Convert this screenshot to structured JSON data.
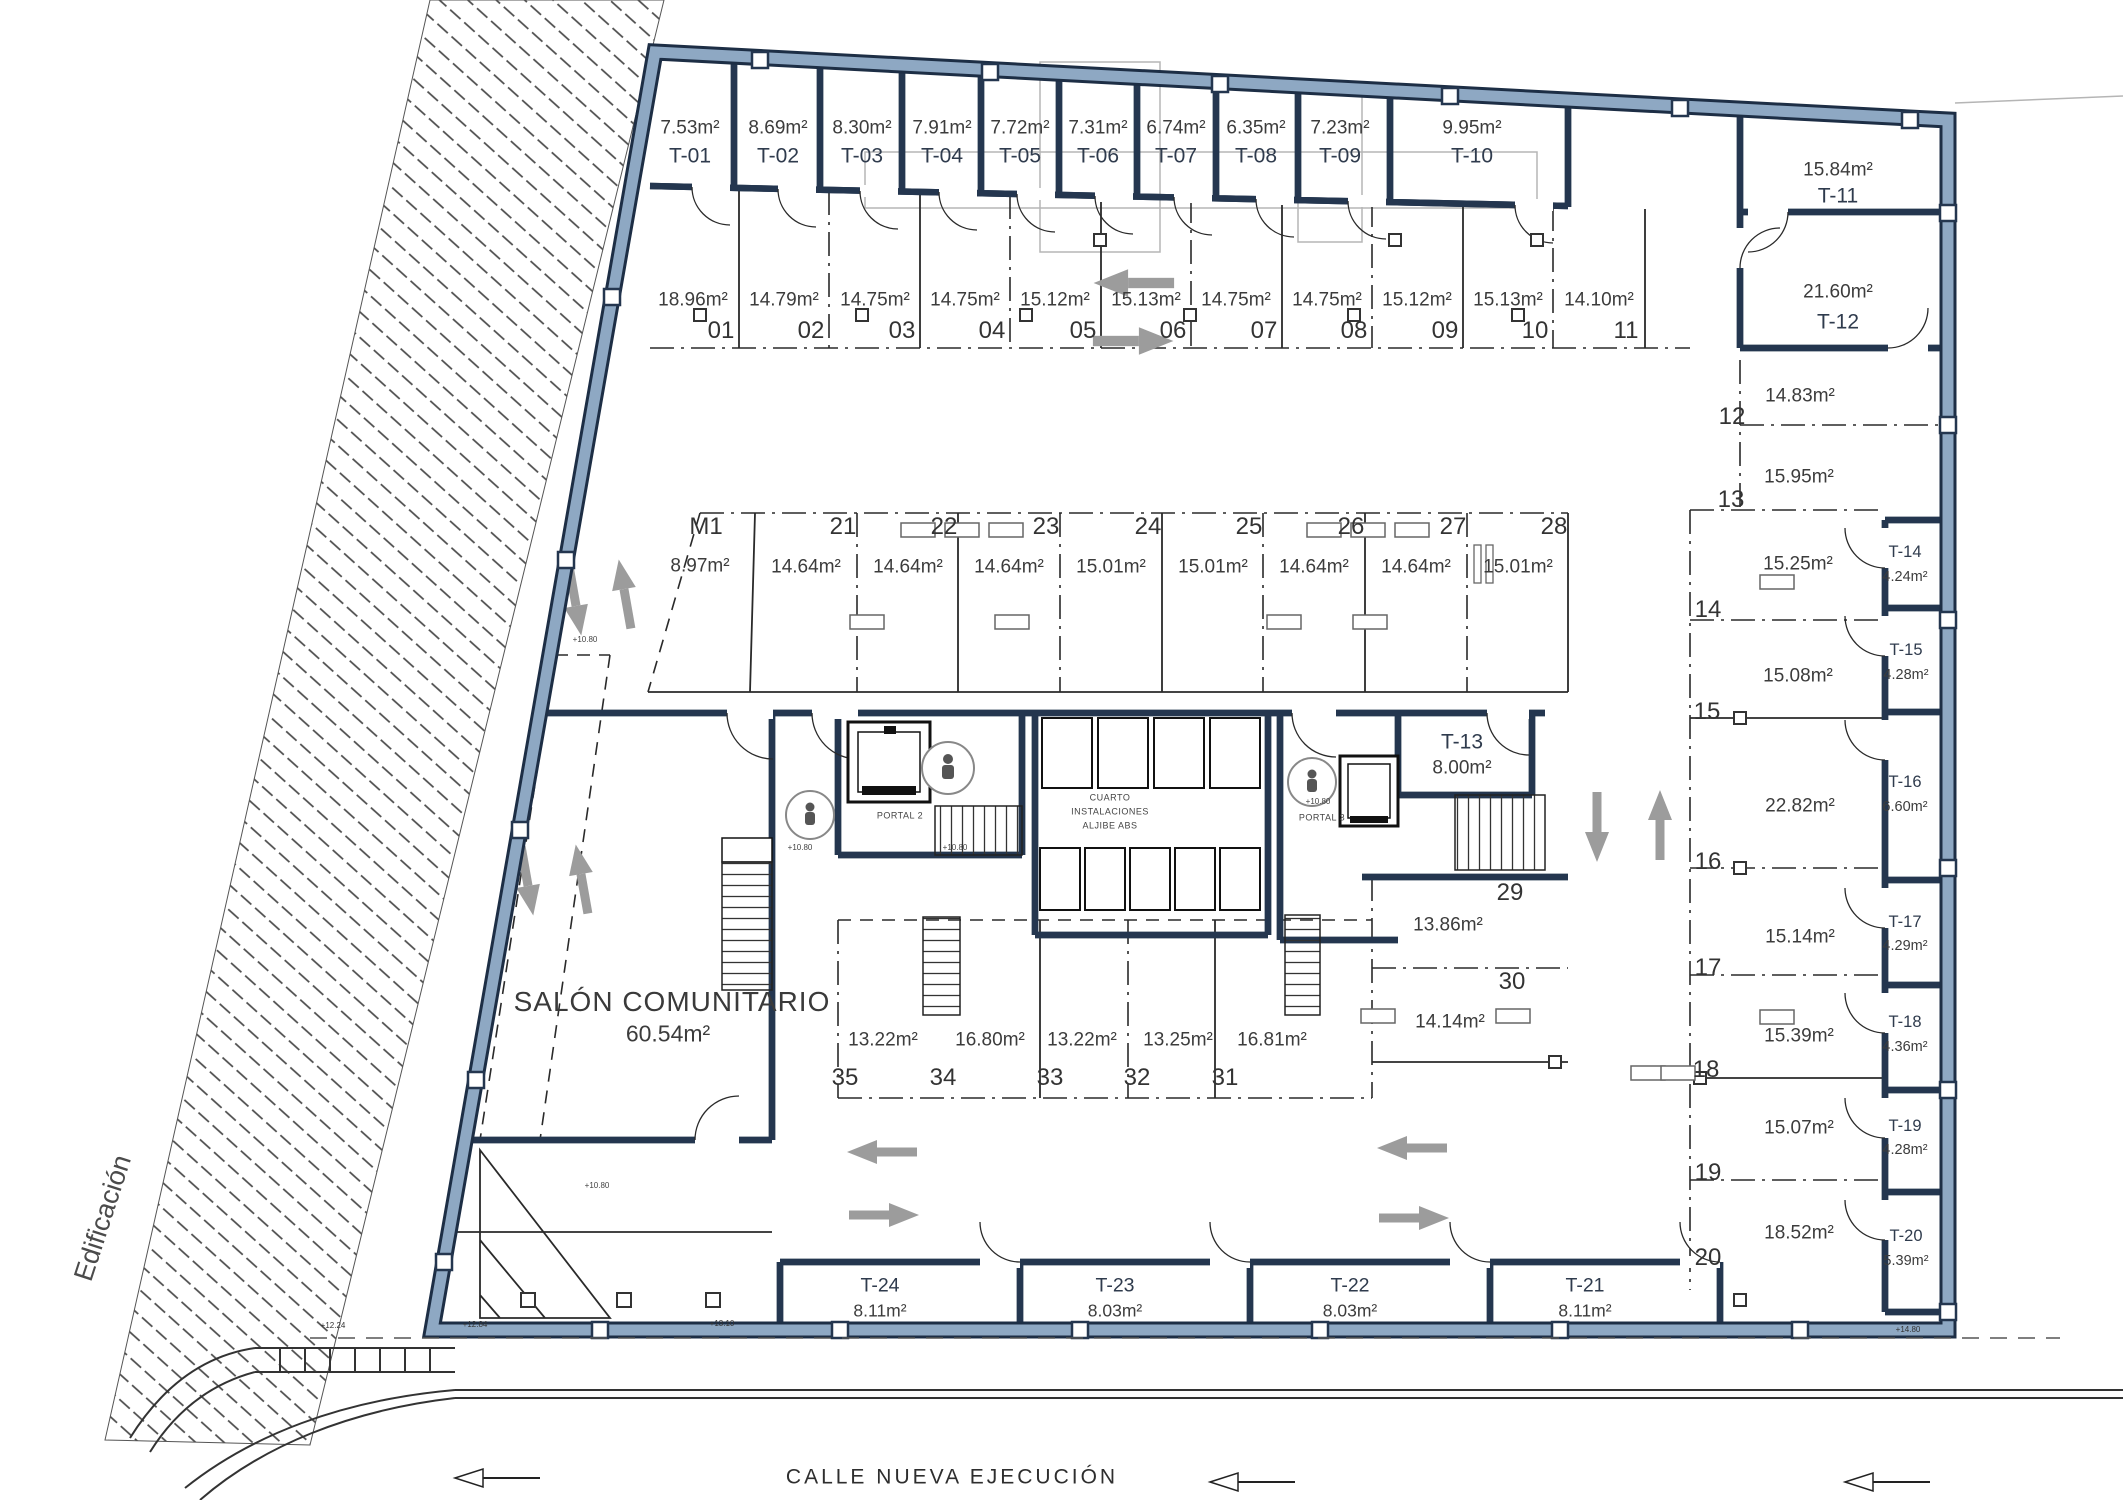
{
  "street": {
    "name": "CALLE NUEVA EJECUCIÓN"
  },
  "context": {
    "adjacent_label": "Edificación"
  },
  "storage_rooms": [
    {
      "id": "T-01",
      "area": "7.53m²",
      "x": 690,
      "y_area": 128,
      "y_id": 156,
      "size": "std"
    },
    {
      "id": "T-02",
      "area": "8.69m²",
      "x": 778,
      "y_area": 128,
      "y_id": 156,
      "size": "std"
    },
    {
      "id": "T-03",
      "area": "8.30m²",
      "x": 862,
      "y_area": 128,
      "y_id": 156,
      "size": "std"
    },
    {
      "id": "T-04",
      "area": "7.91m²",
      "x": 942,
      "y_area": 128,
      "y_id": 156,
      "size": "std"
    },
    {
      "id": "T-05",
      "area": "7.72m²",
      "x": 1020,
      "y_area": 128,
      "y_id": 156,
      "size": "std"
    },
    {
      "id": "T-06",
      "area": "7.31m²",
      "x": 1098,
      "y_area": 128,
      "y_id": 156,
      "size": "std"
    },
    {
      "id": "T-07",
      "area": "6.74m²",
      "x": 1176,
      "y_area": 128,
      "y_id": 156,
      "size": "std"
    },
    {
      "id": "T-08",
      "area": "6.35m²",
      "x": 1256,
      "y_area": 128,
      "y_id": 156,
      "size": "std"
    },
    {
      "id": "T-09",
      "area": "7.23m²",
      "x": 1340,
      "y_area": 128,
      "y_id": 156,
      "size": "std"
    },
    {
      "id": "T-10",
      "area": "9.95m²",
      "x": 1472,
      "y_area": 128,
      "y_id": 156,
      "size": "std"
    },
    {
      "id": "T-11",
      "area": "15.84m²",
      "x": 1838,
      "y_area": 170,
      "y_id": 196,
      "size": "std"
    },
    {
      "id": "T-12",
      "area": "21.60m²",
      "x": 1838,
      "y_area": 292,
      "y_id": 322,
      "size": "std"
    },
    {
      "id": "T-13",
      "area": "8.00m²",
      "x": 1462,
      "y_area": 768,
      "y_id": 742,
      "size": "std"
    },
    {
      "id": "T-14",
      "area": "4.24m²",
      "x": 1905,
      "y_area": 577,
      "y_id": 552,
      "size": "sm"
    },
    {
      "id": "T-15",
      "area": "4.28m²",
      "x": 1906,
      "y_area": 675,
      "y_id": 650,
      "size": "sm"
    },
    {
      "id": "T-16",
      "area": "6.60m²",
      "x": 1905,
      "y_area": 807,
      "y_id": 782,
      "size": "sm"
    },
    {
      "id": "T-17",
      "area": "4.29m²",
      "x": 1905,
      "y_area": 946,
      "y_id": 922,
      "size": "sm"
    },
    {
      "id": "T-18",
      "area": "4.36m²",
      "x": 1905,
      "y_area": 1047,
      "y_id": 1022,
      "size": "sm"
    },
    {
      "id": "T-19",
      "area": "4.28m²",
      "x": 1905,
      "y_area": 1150,
      "y_id": 1126,
      "size": "sm"
    },
    {
      "id": "T-20",
      "area": "5.39m²",
      "x": 1906,
      "y_area": 1261,
      "y_id": 1236,
      "size": "sm"
    },
    {
      "id": "T-24",
      "area": "8.11m²",
      "x": 880,
      "y_area": 1311,
      "y_id": 1286,
      "size": "md"
    },
    {
      "id": "T-23",
      "area": "8.03m²",
      "x": 1115,
      "y_area": 1311,
      "y_id": 1286,
      "size": "md"
    },
    {
      "id": "T-22",
      "area": "8.03m²",
      "x": 1350,
      "y_area": 1311,
      "y_id": 1286,
      "size": "md"
    },
    {
      "id": "T-21",
      "area": "8.11m²",
      "x": 1585,
      "y_area": 1311,
      "y_id": 1286,
      "size": "md"
    }
  ],
  "parking_spaces": [
    {
      "num": "01",
      "area": "18.96m²",
      "ax": 693,
      "ay": 300,
      "nx": 721,
      "ny": 331
    },
    {
      "num": "02",
      "area": "14.79m²",
      "ax": 784,
      "ay": 300,
      "nx": 811,
      "ny": 331
    },
    {
      "num": "03",
      "area": "14.75m²",
      "ax": 875,
      "ay": 300,
      "nx": 902,
      "ny": 331
    },
    {
      "num": "04",
      "area": "14.75m²",
      "ax": 965,
      "ay": 300,
      "nx": 992,
      "ny": 331
    },
    {
      "num": "05",
      "area": "15.12m²",
      "ax": 1055,
      "ay": 300,
      "nx": 1083,
      "ny": 331
    },
    {
      "num": "06",
      "area": "15.13m²",
      "ax": 1146,
      "ay": 300,
      "nx": 1173,
      "ny": 331
    },
    {
      "num": "07",
      "area": "14.75m²",
      "ax": 1236,
      "ay": 300,
      "nx": 1264,
      "ny": 331
    },
    {
      "num": "08",
      "area": "14.75m²",
      "ax": 1327,
      "ay": 300,
      "nx": 1354,
      "ny": 331
    },
    {
      "num": "09",
      "area": "15.12m²",
      "ax": 1417,
      "ay": 300,
      "nx": 1445,
      "ny": 331
    },
    {
      "num": "10",
      "area": "15.13m²",
      "ax": 1508,
      "ay": 300,
      "nx": 1535,
      "ny": 331
    },
    {
      "num": "11",
      "area": "14.10m²",
      "ax": 1599,
      "ay": 300,
      "nx": 1626,
      "ny": 331
    },
    {
      "num": "M1",
      "area": "8.97m²",
      "ax": 700,
      "ay": 566,
      "nx": 706,
      "ny": 527
    },
    {
      "num": "21",
      "area": "14.64m²",
      "ax": 806,
      "ay": 567,
      "nx": 843,
      "ny": 527
    },
    {
      "num": "22",
      "area": "14.64m²",
      "ax": 908,
      "ay": 567,
      "nx": 944,
      "ny": 527
    },
    {
      "num": "23",
      "area": "14.64m²",
      "ax": 1009,
      "ay": 567,
      "nx": 1046,
      "ny": 527
    },
    {
      "num": "24",
      "area": "15.01m²",
      "ax": 1111,
      "ay": 567,
      "nx": 1148,
      "ny": 527
    },
    {
      "num": "25",
      "area": "15.01m²",
      "ax": 1213,
      "ay": 567,
      "nx": 1249,
      "ny": 527
    },
    {
      "num": "26",
      "area": "14.64m²",
      "ax": 1314,
      "ay": 567,
      "nx": 1351,
      "ny": 527
    },
    {
      "num": "27",
      "area": "14.64m²",
      "ax": 1416,
      "ay": 567,
      "nx": 1453,
      "ny": 527
    },
    {
      "num": "28",
      "area": "15.01m²",
      "ax": 1518,
      "ay": 567,
      "nx": 1554,
      "ny": 527
    },
    {
      "num": "12",
      "area": "14.83m²",
      "ax": 1800,
      "ay": 396,
      "nx": 1732,
      "ny": 417
    },
    {
      "num": "13",
      "area": "15.95m²",
      "ax": 1799,
      "ay": 477,
      "nx": 1731,
      "ny": 500
    },
    {
      "num": "14",
      "area": "15.25m²",
      "ax": 1798,
      "ay": 564,
      "nx": 1708,
      "ny": 610
    },
    {
      "num": "15",
      "area": "15.08m²",
      "ax": 1798,
      "ay": 676,
      "nx": 1707,
      "ny": 712
    },
    {
      "num": "16",
      "area": "22.82m²",
      "ax": 1800,
      "ay": 806,
      "nx": 1708,
      "ny": 862
    },
    {
      "num": "17",
      "area": "15.14m²",
      "ax": 1800,
      "ay": 937,
      "nx": 1708,
      "ny": 968
    },
    {
      "num": "18",
      "area": "15.39m²",
      "ax": 1799,
      "ay": 1036,
      "nx": 1706,
      "ny": 1070
    },
    {
      "num": "19",
      "area": "15.07m²",
      "ax": 1799,
      "ay": 1128,
      "nx": 1708,
      "ny": 1173
    },
    {
      "num": "20",
      "area": "18.52m²",
      "ax": 1799,
      "ay": 1233,
      "nx": 1708,
      "ny": 1258
    },
    {
      "num": "29",
      "area": "13.86m²",
      "ax": 1448,
      "ay": 925,
      "nx": 1510,
      "ny": 893
    },
    {
      "num": "30",
      "area": "14.14m²",
      "ax": 1450,
      "ay": 1022,
      "nx": 1512,
      "ny": 982
    },
    {
      "num": "31",
      "area": "16.81m²",
      "ax": 1272,
      "ay": 1040,
      "nx": 1225,
      "ny": 1078
    },
    {
      "num": "32",
      "area": "13.25m²",
      "ax": 1178,
      "ay": 1040,
      "nx": 1137,
      "ny": 1078
    },
    {
      "num": "33",
      "area": "13.22m²",
      "ax": 1082,
      "ay": 1040,
      "nx": 1050,
      "ny": 1078
    },
    {
      "num": "34",
      "area": "16.80m²",
      "ax": 990,
      "ay": 1040,
      "nx": 943,
      "ny": 1078
    },
    {
      "num": "35",
      "area": "13.22m²",
      "ax": 883,
      "ay": 1040,
      "nx": 845,
      "ny": 1078
    }
  ],
  "annotations": [
    {
      "name": "community-room-name",
      "text": "SALÓN COMUNITARIO",
      "x": 672,
      "y": 1002,
      "cls": "salon1"
    },
    {
      "name": "community-room-area",
      "text": "60.54m²",
      "x": 668,
      "y": 1034,
      "cls": "salon2"
    },
    {
      "name": "installations-room-line1",
      "text": "CUARTO",
      "x": 1110,
      "y": 798,
      "cls": "tiny"
    },
    {
      "name": "installations-room-line2",
      "text": "INSTALACIONES",
      "x": 1110,
      "y": 812,
      "cls": "tiny"
    },
    {
      "name": "installations-room-line3",
      "text": "ALJIBE ABS",
      "x": 1110,
      "y": 826,
      "cls": "tiny"
    },
    {
      "name": "portal-2-label",
      "text": "PORTAL 2",
      "x": 900,
      "y": 816,
      "cls": "tiny"
    },
    {
      "name": "portal-3-label",
      "text": "PORTAL 3",
      "x": 1322,
      "y": 818,
      "cls": "tiny"
    },
    {
      "name": "level-mark",
      "text": "+10.80",
      "x": 800,
      "y": 848,
      "cls": "tiny2"
    },
    {
      "name": "level-mark",
      "text": "+10.80",
      "x": 955,
      "y": 848,
      "cls": "tiny2"
    },
    {
      "name": "level-mark",
      "text": "+10.80",
      "x": 1318,
      "y": 802,
      "cls": "tiny2"
    },
    {
      "name": "level-mark",
      "text": "+10.80",
      "x": 585,
      "y": 640,
      "cls": "tiny2"
    },
    {
      "name": "level-mark",
      "text": "+10.80",
      "x": 597,
      "y": 1186,
      "cls": "tiny2"
    },
    {
      "name": "elevation-mark",
      "text": "+12.24",
      "x": 333,
      "y": 1326,
      "cls": "elev"
    },
    {
      "name": "elevation-mark",
      "text": "+12.84",
      "x": 475,
      "y": 1325,
      "cls": "elev"
    },
    {
      "name": "elevation-mark",
      "text": "+13.10",
      "x": 722,
      "y": 1324,
      "cls": "elev"
    },
    {
      "name": "elevation-mark",
      "text": "+14.80",
      "x": 1908,
      "y": 1330,
      "cls": "elev"
    }
  ]
}
